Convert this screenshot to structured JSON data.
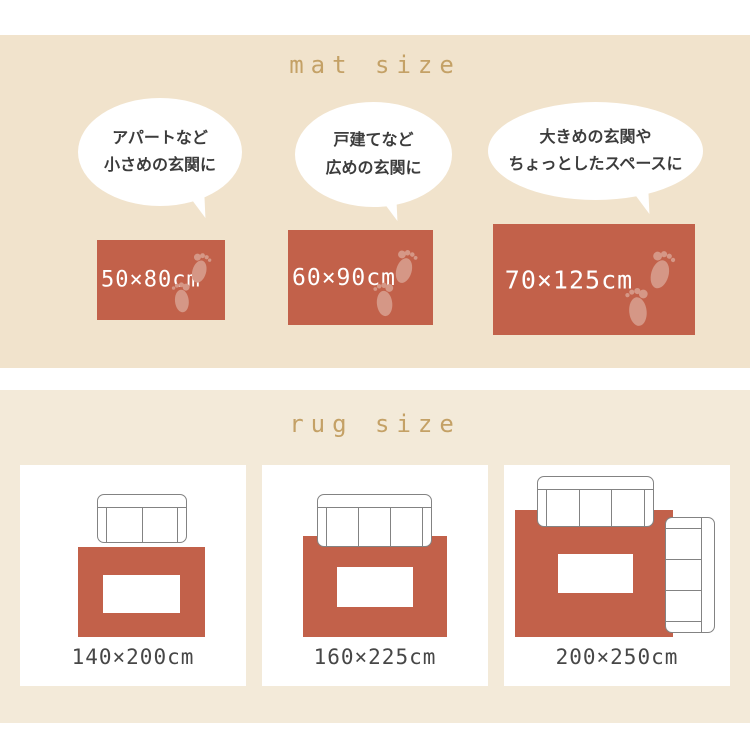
{
  "colors": {
    "mat_section_bg": "#f1e3cc",
    "rug_section_bg": "#f3ead9",
    "terracotta": "#c2614a",
    "footprint": "#d59786",
    "title_gold": "#c4a166",
    "text_dark": "#3c3c3c",
    "sofa_outline": "#838383",
    "label_gray": "#474747"
  },
  "mat_section": {
    "title": "mat size",
    "items": [
      {
        "bubble_line1": "アパートなど",
        "bubble_line2": "小さめの玄関に",
        "size": "50×80cm"
      },
      {
        "bubble_line1": "戸建てなど",
        "bubble_line2": "広めの玄関に",
        "size": "60×90cm"
      },
      {
        "bubble_line1": "大きめの玄関や",
        "bubble_line2": "ちょっとしたスペースに",
        "size": "70×125cm"
      }
    ]
  },
  "rug_section": {
    "title": "rug size",
    "items": [
      {
        "size": "140×200cm"
      },
      {
        "size": "160×225cm"
      },
      {
        "size": "200×250cm"
      }
    ]
  }
}
